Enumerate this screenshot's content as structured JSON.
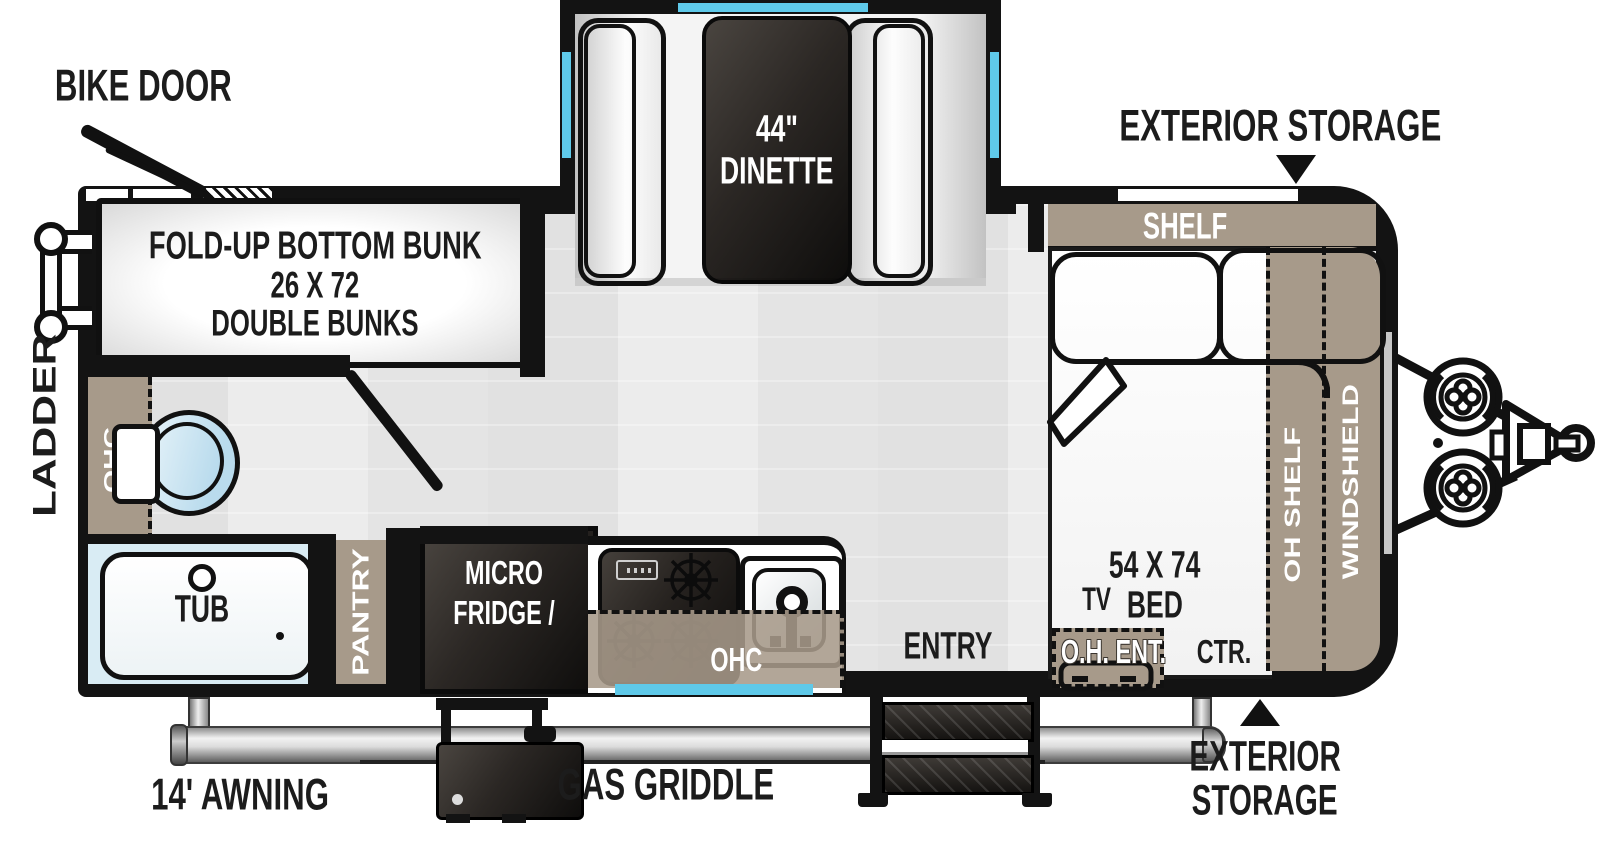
{
  "plan": {
    "bike_door": "BIKE DOOR",
    "exterior_storage_top": "EXTERIOR STORAGE",
    "exterior_storage_bottom_l1": "EXTERIOR",
    "exterior_storage_bottom_l2": "STORAGE",
    "ladder": "LADDER",
    "awning": "14' AWNING",
    "gas_griddle": "GAS GRIDDLE",
    "entry": "ENTRY",
    "bunk_l1": "FOLD-UP BOTTOM BUNK",
    "bunk_l2": "26 X 72",
    "bunk_l3": "DOUBLE BUNKS",
    "dinette_l1": "44\"",
    "dinette_l2": "DINETTE",
    "shelf": "SHELF",
    "oh_shelf": "OH SHELF",
    "windshield": "WINDSHIELD",
    "bed_l1": "54 X 74",
    "bed_l2": "BED",
    "tv": "TV",
    "oh_ent": "O.H. ENT.",
    "ctr": "CTR.",
    "tub": "TUB",
    "ohc_bath": "OHC",
    "ohc_kitchen": "OHC",
    "pantry": "PANTRY",
    "micro_l1": "MICRO",
    "micro_l2": "FRIDGE /"
  },
  "colors": {
    "tan": "#a79a8a",
    "window_blue": "#5fc9e9",
    "wall_black": "#131313",
    "floor_gray": "#e9e9e9",
    "tub_blue": "#d9ecf4",
    "appliance_dark": "#211e1c"
  }
}
